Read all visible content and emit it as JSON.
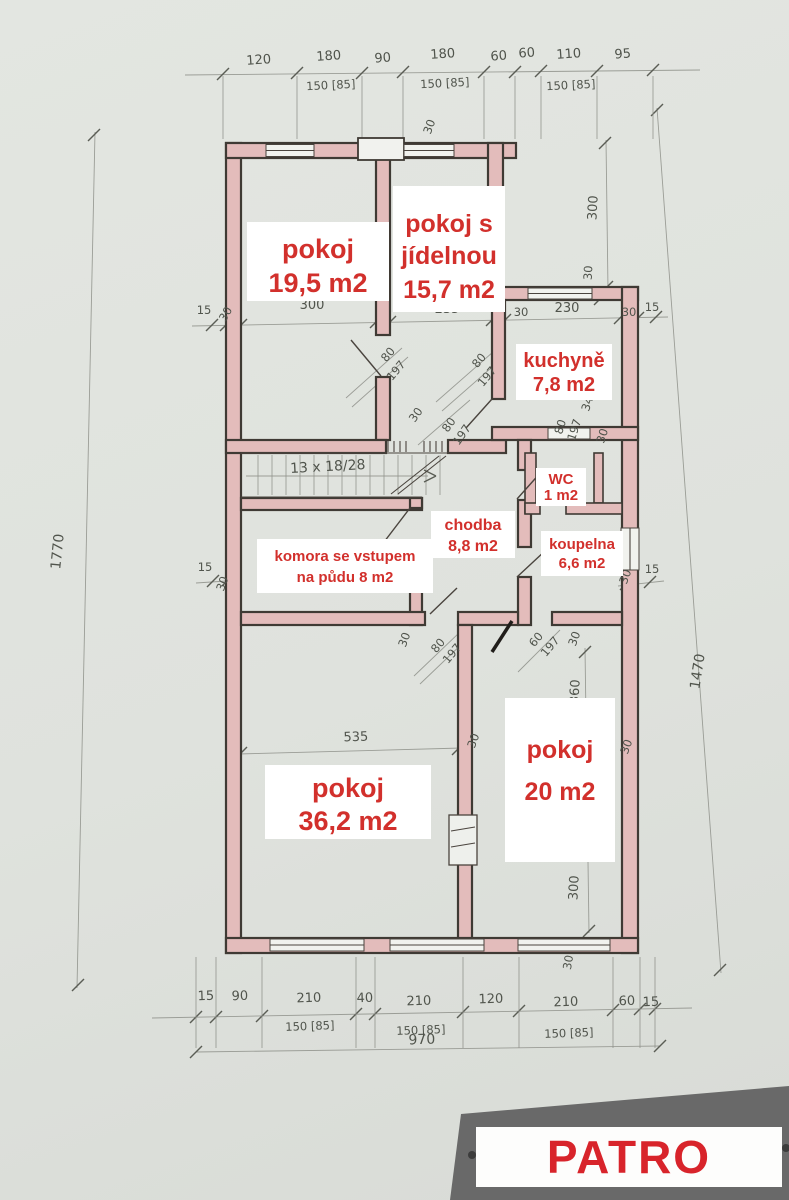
{
  "document_title": "PATRO",
  "colors": {
    "paper": "#dfe2dd",
    "wall_outline": "#3f3a34",
    "wall_fill": "#e3bcbb",
    "dimension_ink": "#50544c",
    "label_red": "#d2302c",
    "label_bg": "#ffffff",
    "scan_corner": "#696969"
  },
  "rooms": [
    {
      "id": "pokoj-19-5",
      "line1": "pokoj",
      "line2": "19,5 m2"
    },
    {
      "id": "pokoj-s-jidelnou",
      "line1": "pokoj s",
      "line2": "jídelnou",
      "line3": "15,7 m2"
    },
    {
      "id": "kuchyne",
      "line1": "kuchyně",
      "line2": "7,8 m2"
    },
    {
      "id": "wc",
      "line1": "WC",
      "line2": "1 m2"
    },
    {
      "id": "chodba",
      "line1": "chodba",
      "line2": "8,8 m2"
    },
    {
      "id": "koupelna",
      "line1": "koupelna",
      "line2": "6,6 m2"
    },
    {
      "id": "komora",
      "line1": "komora se vstupem",
      "line2": "na půdu  8 m2"
    },
    {
      "id": "pokoj-36-2",
      "line1": "pokoj",
      "line2": "36,2 m2"
    },
    {
      "id": "pokoj-20",
      "line1": "pokoj",
      "line2": "20 m2"
    }
  ],
  "stairs": {
    "note": "13 x 18/28"
  },
  "dims": {
    "top": [
      "120",
      "180",
      "90",
      "180",
      "60",
      "60",
      "110",
      "95"
    ],
    "top_sub": [
      "150 [85]",
      "150 [85]",
      "150 [85]"
    ],
    "row_a": [
      "15",
      "30",
      "300",
      "235",
      "30",
      "230",
      "30",
      "15"
    ],
    "top_wall": "30",
    "right_upper": [
      "300",
      "30"
    ],
    "doors_a": [
      "80",
      "197"
    ],
    "doors_b": [
      "80",
      "197"
    ],
    "doors_c": [
      "30",
      "80",
      "197"
    ],
    "kitchen": [
      "80",
      "197",
      "34",
      "30"
    ],
    "mid": [
      "30",
      "80",
      "197",
      "60",
      "197",
      "30"
    ],
    "room36": [
      "535",
      "30",
      "30"
    ],
    "right_lower": [
      "360",
      "300",
      "30"
    ],
    "row_b_left": [
      "15",
      "30"
    ],
    "row_b_right": [
      "30",
      "15"
    ],
    "bottom": [
      "15",
      "90",
      "210",
      "40",
      "210",
      "120",
      "210",
      "60",
      "15"
    ],
    "bottom_sub": [
      "150 [85]",
      "150 [85]",
      "150 [85]"
    ],
    "bottom_total": "970",
    "left_total": "1770",
    "right_total": "1470"
  }
}
